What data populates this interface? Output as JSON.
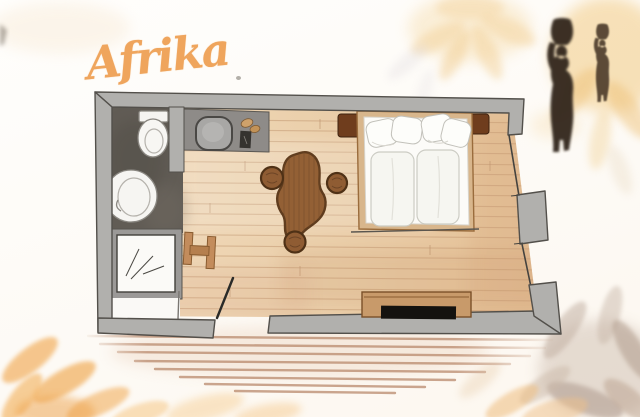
{
  "artwork": {
    "title": "Afrika"
  },
  "colors": {
    "title_accent": "#efa55d",
    "wall_gray": "#b1b0ad",
    "wall_outline": "#53504b",
    "floor_tan": "#ead0ae",
    "plank_line": "#c49a74",
    "bathroom_floor": "#615c55",
    "counter_gray": "#8e8b88",
    "wood_furniture": "#c89a6a",
    "nightstand_brown": "#6f3d1d",
    "rug_brown": "#936035",
    "tv_black": "#14120f",
    "silhouette_brown": "#32261a",
    "watercolor_yellow": "#f3cf8e",
    "watercolor_orange": "#f2b061",
    "watercolor_taupe": "#beab9d"
  },
  "floorplan": {
    "fixtures": [
      "toilet",
      "washbasin",
      "shower",
      "vanity-counter",
      "vanity-basin",
      "double-bed",
      "pillows",
      "duvets",
      "nightstand-left",
      "nightstand-right",
      "hide-rug",
      "pouf-left",
      "pouf-right",
      "pouf-bottom",
      "stool",
      "sideboard",
      "tv",
      "entry-door",
      "window-upper",
      "window-lower",
      "terrace-planks"
    ]
  },
  "decor": {
    "figures": [
      "african-woman-silhouette-large",
      "african-woman-silhouette-small"
    ],
    "background": [
      "watercolor-flower-top",
      "watercolor-leaves-bottom-left",
      "watercolor-leaves-bottom-right"
    ]
  }
}
